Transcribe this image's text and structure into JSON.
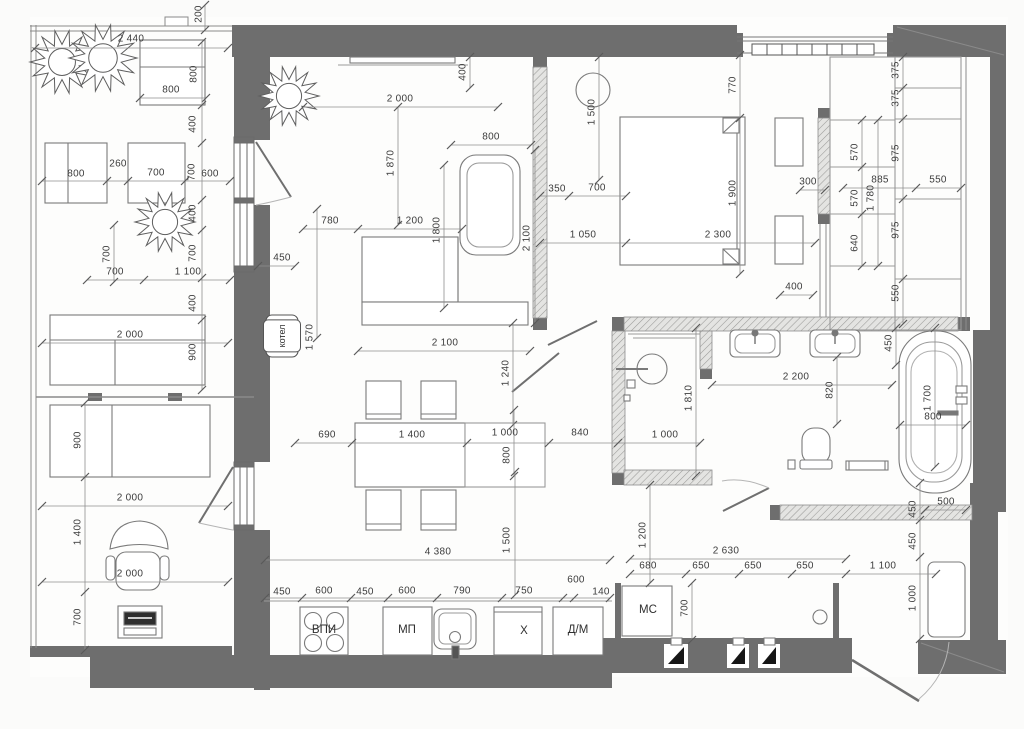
{
  "drawing": {
    "type": "apartment floor plan with furniture and dimension chains",
    "units": "mm",
    "wall_color": "#6e6e6e",
    "line_color": "#8f8f8f",
    "text_color": "#3c3c3c"
  },
  "appliance_labels": [
    {
      "text": "ВПИ",
      "x": 324,
      "y": 630,
      "name": "label-cooktop"
    },
    {
      "text": "МП",
      "x": 407,
      "y": 630,
      "name": "label-microwave"
    },
    {
      "text": "Х",
      "x": 524,
      "y": 631,
      "name": "label-fridge"
    },
    {
      "text": "Д/М",
      "x": 578,
      "y": 630,
      "name": "label-dishwasher"
    },
    {
      "text": "МС",
      "x": 648,
      "y": 610,
      "name": "label-washing-machine"
    },
    {
      "text": "котел",
      "x": 282,
      "y": 336,
      "rot": true,
      "boxed": true,
      "name": "label-boiler"
    }
  ],
  "dimension_labels": [
    {
      "text": "200",
      "x": 199,
      "y": 14,
      "rot": true
    },
    {
      "text": "2 440",
      "x": 131,
      "y": 39
    },
    {
      "text": "800",
      "x": 194,
      "y": 74,
      "rot": true
    },
    {
      "text": "800",
      "x": 171,
      "y": 90
    },
    {
      "text": "400",
      "x": 193,
      "y": 124,
      "rot": true
    },
    {
      "text": "800",
      "x": 76,
      "y": 174
    },
    {
      "text": "260",
      "x": 118,
      "y": 164
    },
    {
      "text": "700",
      "x": 156,
      "y": 173
    },
    {
      "text": "700",
      "x": 192,
      "y": 172,
      "rot": true
    },
    {
      "text": "600",
      "x": 210,
      "y": 174
    },
    {
      "text": "400",
      "x": 193,
      "y": 213,
      "rot": true
    },
    {
      "text": "700",
      "x": 107,
      "y": 254,
      "rot": true
    },
    {
      "text": "700",
      "x": 115,
      "y": 272
    },
    {
      "text": "700",
      "x": 193,
      "y": 253,
      "rot": true
    },
    {
      "text": "1 100",
      "x": 188,
      "y": 272
    },
    {
      "text": "400",
      "x": 193,
      "y": 303,
      "rot": true
    },
    {
      "text": "2 000",
      "x": 130,
      "y": 335
    },
    {
      "text": "900",
      "x": 193,
      "y": 352,
      "rot": true
    },
    {
      "text": "900",
      "x": 78,
      "y": 440,
      "rot": true
    },
    {
      "text": "2 000",
      "x": 130,
      "y": 498
    },
    {
      "text": "1 400",
      "x": 78,
      "y": 532,
      "rot": true
    },
    {
      "text": "2 000",
      "x": 130,
      "y": 574
    },
    {
      "text": "700",
      "x": 78,
      "y": 617,
      "rot": true
    },
    {
      "text": "400",
      "x": 463,
      "y": 72,
      "rot": true
    },
    {
      "text": "2 000",
      "x": 400,
      "y": 99
    },
    {
      "text": "1 870",
      "x": 391,
      "y": 163,
      "rot": true
    },
    {
      "text": "800",
      "x": 491,
      "y": 137
    },
    {
      "text": "780",
      "x": 330,
      "y": 221
    },
    {
      "text": "1 200",
      "x": 410,
      "y": 221
    },
    {
      "text": "1 800",
      "x": 437,
      "y": 230,
      "rot": true
    },
    {
      "text": "2 100",
      "x": 527,
      "y": 238,
      "rot": true
    },
    {
      "text": "450",
      "x": 282,
      "y": 258
    },
    {
      "text": "1 570",
      "x": 310,
      "y": 337,
      "rot": true
    },
    {
      "text": "2 100",
      "x": 445,
      "y": 343
    },
    {
      "text": "1 240",
      "x": 506,
      "y": 373,
      "rot": true
    },
    {
      "text": "690",
      "x": 327,
      "y": 435
    },
    {
      "text": "1 400",
      "x": 412,
      "y": 435
    },
    {
      "text": "1 000",
      "x": 505,
      "y": 433
    },
    {
      "text": "800",
      "x": 507,
      "y": 455,
      "rot": true
    },
    {
      "text": "840",
      "x": 580,
      "y": 433
    },
    {
      "text": "1 500",
      "x": 507,
      "y": 540,
      "rot": true
    },
    {
      "text": "4 380",
      "x": 438,
      "y": 552
    },
    {
      "text": "770",
      "x": 733,
      "y": 85,
      "rot": true
    },
    {
      "text": "1 500",
      "x": 592,
      "y": 112,
      "rot": true
    },
    {
      "text": "350",
      "x": 557,
      "y": 189
    },
    {
      "text": "700",
      "x": 597,
      "y": 188
    },
    {
      "text": "1 900",
      "x": 733,
      "y": 193,
      "rot": true
    },
    {
      "text": "300",
      "x": 808,
      "y": 182
    },
    {
      "text": "1 050",
      "x": 583,
      "y": 235
    },
    {
      "text": "2 300",
      "x": 718,
      "y": 235
    },
    {
      "text": "400",
      "x": 794,
      "y": 287
    },
    {
      "text": "375",
      "x": 896,
      "y": 70,
      "rot": true
    },
    {
      "text": "375",
      "x": 896,
      "y": 98,
      "rot": true
    },
    {
      "text": "570",
      "x": 855,
      "y": 152,
      "rot": true
    },
    {
      "text": "975",
      "x": 896,
      "y": 153,
      "rot": true
    },
    {
      "text": "885",
      "x": 880,
      "y": 180
    },
    {
      "text": "550",
      "x": 938,
      "y": 180
    },
    {
      "text": "570",
      "x": 855,
      "y": 198,
      "rot": true
    },
    {
      "text": "1 780",
      "x": 871,
      "y": 198,
      "rot": true
    },
    {
      "text": "640",
      "x": 855,
      "y": 243,
      "rot": true
    },
    {
      "text": "975",
      "x": 896,
      "y": 230,
      "rot": true
    },
    {
      "text": "550",
      "x": 896,
      "y": 293,
      "rot": true
    },
    {
      "text": "1 810",
      "x": 689,
      "y": 398,
      "rot": true
    },
    {
      "text": "1 000",
      "x": 665,
      "y": 435
    },
    {
      "text": "2 200",
      "x": 796,
      "y": 377
    },
    {
      "text": "820",
      "x": 830,
      "y": 390,
      "rot": true
    },
    {
      "text": "450",
      "x": 889,
      "y": 343,
      "rot": true
    },
    {
      "text": "1 700",
      "x": 928,
      "y": 398,
      "rot": true
    },
    {
      "text": "800",
      "x": 933,
      "y": 417
    },
    {
      "text": "1 200",
      "x": 643,
      "y": 535,
      "rot": true
    },
    {
      "text": "2 630",
      "x": 726,
      "y": 551
    },
    {
      "text": "680",
      "x": 648,
      "y": 566
    },
    {
      "text": "650",
      "x": 701,
      "y": 566
    },
    {
      "text": "650",
      "x": 753,
      "y": 566
    },
    {
      "text": "650",
      "x": 805,
      "y": 566
    },
    {
      "text": "1 100",
      "x": 883,
      "y": 566
    },
    {
      "text": "700",
      "x": 685,
      "y": 608,
      "rot": true
    },
    {
      "text": "450",
      "x": 913,
      "y": 509,
      "rot": true
    },
    {
      "text": "450",
      "x": 913,
      "y": 541,
      "rot": true
    },
    {
      "text": "500",
      "x": 946,
      "y": 502
    },
    {
      "text": "1 000",
      "x": 913,
      "y": 598,
      "rot": true
    },
    {
      "text": "450",
      "x": 282,
      "y": 592
    },
    {
      "text": "600",
      "x": 324,
      "y": 591
    },
    {
      "text": "450",
      "x": 365,
      "y": 592
    },
    {
      "text": "600",
      "x": 407,
      "y": 591
    },
    {
      "text": "790",
      "x": 462,
      "y": 591
    },
    {
      "text": "750",
      "x": 524,
      "y": 591
    },
    {
      "text": "600",
      "x": 576,
      "y": 580
    },
    {
      "text": "140",
      "x": 601,
      "y": 592
    }
  ]
}
